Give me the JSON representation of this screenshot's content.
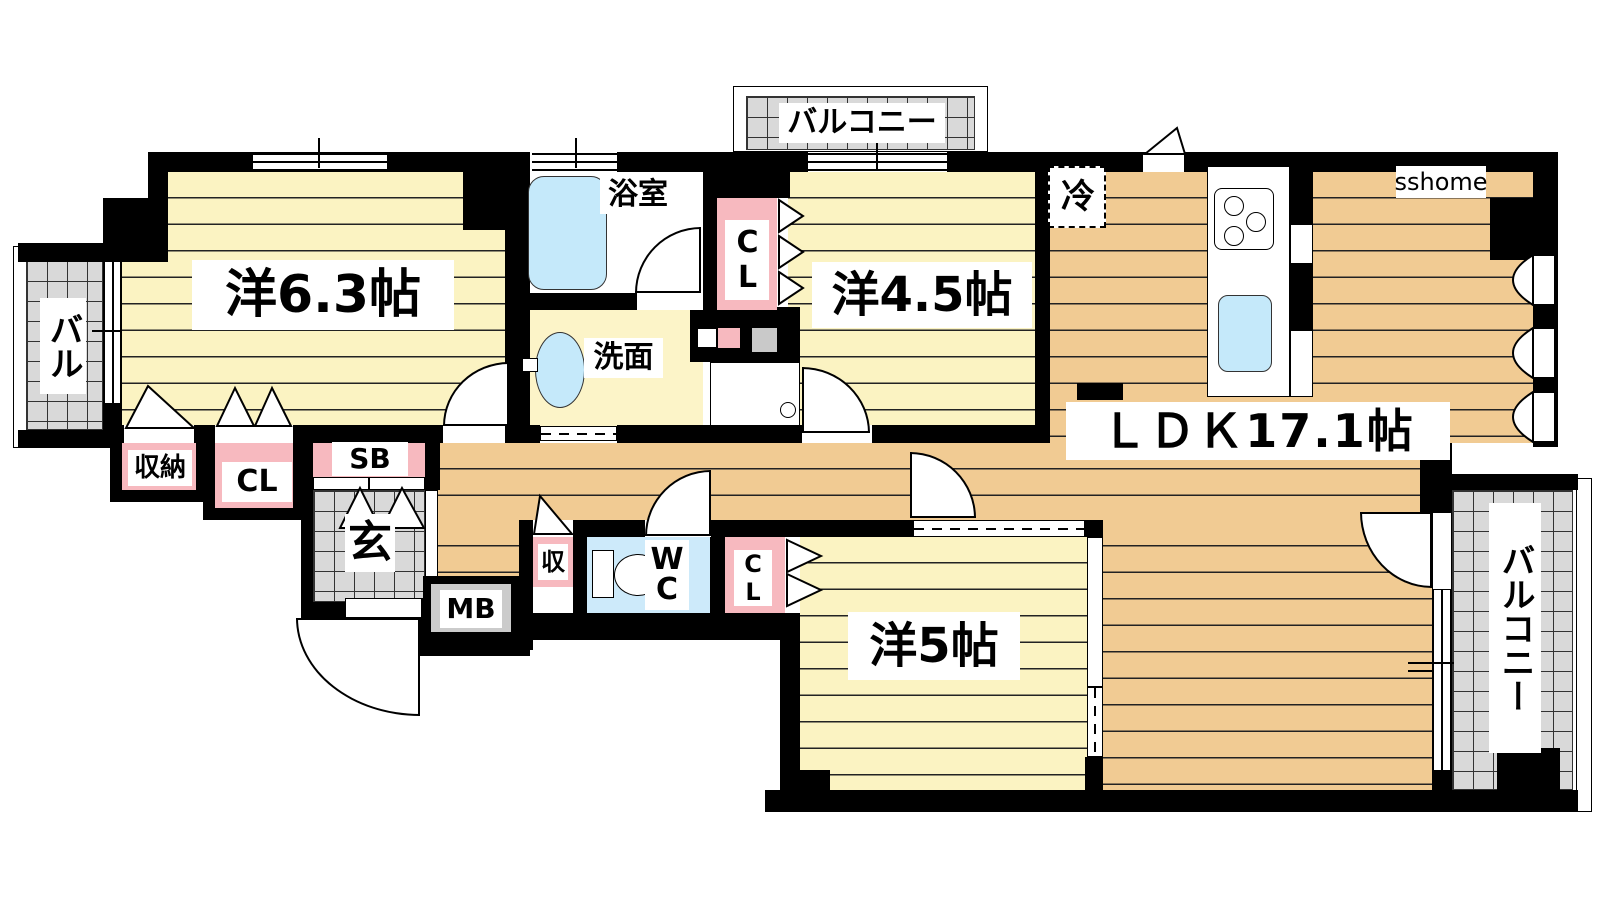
{
  "plan": {
    "brand": "sshome",
    "rooms": {
      "west_bedroom": {
        "label": "洋6.3帖",
        "size_jo": 6.3
      },
      "middle_bedroom": {
        "label": "洋4.5帖",
        "size_jo": 4.5
      },
      "south_bedroom": {
        "label": "洋5帖",
        "size_jo": 5
      },
      "ldk": {
        "label": "ＬＤＫ17.1帖",
        "size_jo": 17.1
      },
      "bath": {
        "label": "浴室"
      },
      "washroom": {
        "label": "洗面"
      },
      "toilet": {
        "label": "WC"
      },
      "entrance": {
        "label": "玄"
      }
    },
    "features": {
      "fridge": {
        "label": "冷"
      },
      "storage_west": {
        "label": "収納"
      },
      "closet_west": {
        "label": "CL"
      },
      "shoe_box": {
        "label": "SB"
      },
      "meter_box": {
        "label": "MB"
      },
      "storage_hall": {
        "label": "収"
      },
      "closet_bath": {
        "label": "CL"
      },
      "closet_south": {
        "label": "CL"
      }
    },
    "balconies": {
      "north": {
        "label": "バルコニー"
      },
      "east": {
        "label": "バルコニー"
      },
      "west": {
        "label": "バル"
      }
    },
    "colors": {
      "wall": "#000000",
      "bedroom_floor": "#FBF3C2",
      "ldk_floor": "#F1CB93",
      "closet_pink": "#F7B9BF",
      "water_blue": "#C5E9FA",
      "balcony_gray": "#D9D9D9",
      "washroom_floor": "#FCF4C8"
    }
  }
}
